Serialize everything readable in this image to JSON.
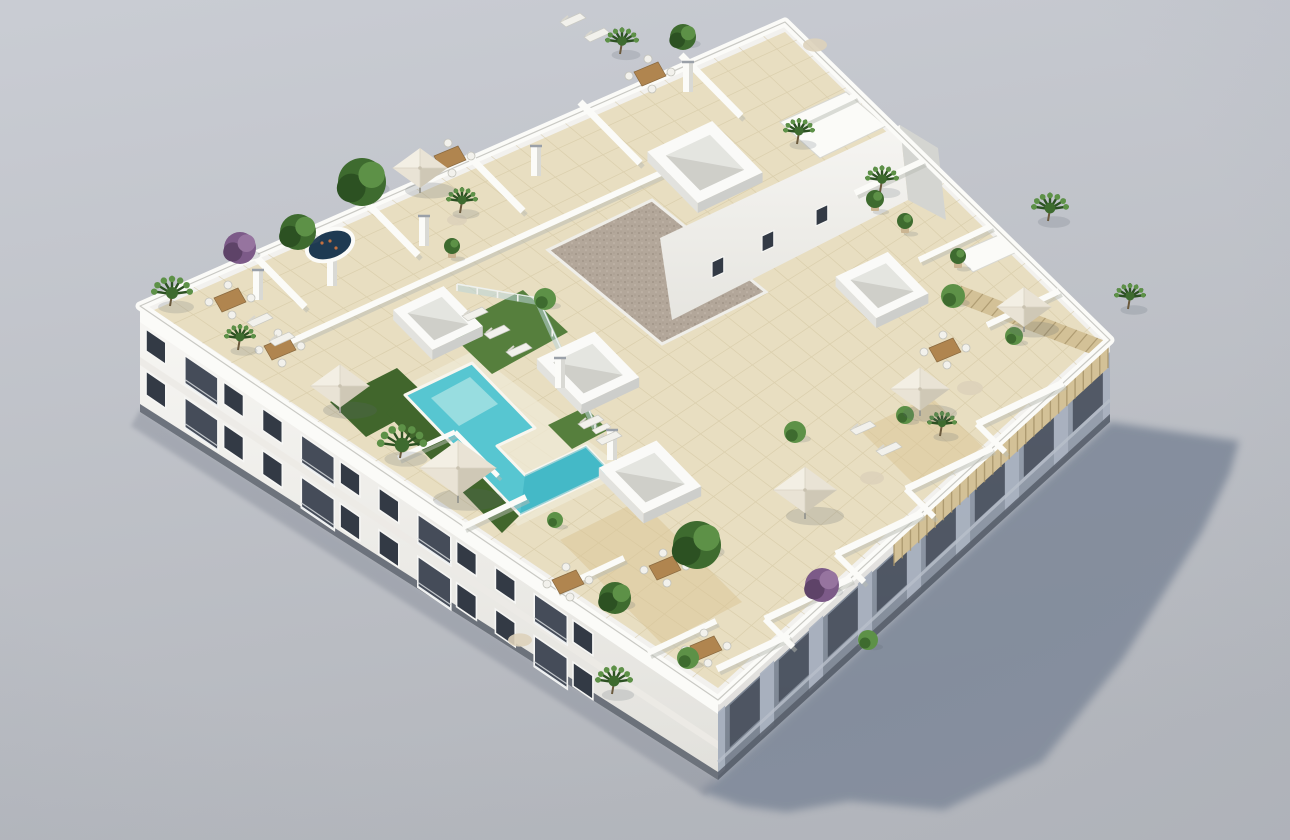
{
  "meta": {
    "title": "Aerial 3D render of a white apartment building with rooftop terraces and communal pool",
    "type": "architectural-render",
    "visible_text": ""
  },
  "scene": {
    "palette": {
      "sky_top": "#c9ccd3",
      "sky_bottom": "#b4b7bd",
      "wall": "#f2f1ee",
      "wall_bright": "#fbfbf8",
      "wall_shade": "#d8d8d3",
      "facade_top": "#f7f6f3",
      "facade_bottom": "#e2e1dc",
      "facade_right_top": "#9ca5b3",
      "facade_right_bottom": "#79828f",
      "recess": "#454c59",
      "window": "#333a45",
      "frame": "#f6f6f4",
      "tile": "#e8dec1",
      "tile_line": "#d2c5a0",
      "wood": "#d9c394",
      "gravel": "#b3a79a",
      "pool": "#57c6d1",
      "pool_light": "#a3e1e3",
      "pool_deep": "#2fa8ba",
      "grass": "#567f3d",
      "grass_dark": "#41662c",
      "plant": "#3e6b2f",
      "plant_dark": "#2c5122",
      "plant_light": "#5d9147",
      "purple": "#7c5a88",
      "purple_dark": "#5e4368",
      "parasol": "#e9e3d5",
      "parasol_lit": "#f3efe4",
      "parasol_shade": "#cfc8b6",
      "jacuzzi": "#1e3a52",
      "furniture_wood": "#b0854f",
      "white_furn": "#f2f1ec",
      "glass": "#bcd6da",
      "shadow": "#7e8899",
      "pergola": "#d3c197",
      "pergola_dark": "#a8956b",
      "base_dark": "#565d68"
    },
    "geo": {
      "quad": {
        "W": [
          140,
          306
        ],
        "N": [
          785,
          22
        ],
        "E": [
          1110,
          340
        ],
        "S": [
          718,
          700
        ]
      },
      "roof": "785,22 1110,340 718,700 140,306",
      "roof_floor": "785,32 1098,340 718,688 154,310",
      "facade_left": "140,306 718,700 718,780 140,412",
      "facade_left_top": "140,306 718,700 718,714 140,322",
      "facade_left_mid": "140,357 718,741 718,749 140,365",
      "facade_left_base": "140,404 718,772 718,780 140,412",
      "facade_right": "718,700 1110,340 1110,422 718,780",
      "facade_right_top": "718,700 1110,340 1110,354 718,714",
      "facade_right_base": "718,772 1110,414 1110,422 718,780",
      "shadow": "718,778 1110,422 1150,428 1239,441 1230,473 1202,532 1123,659 1042,762 944,810 849,801 787,812 742,806 700,791",
      "ground_contact": "140,410 718,778 706,796 131,426",
      "pool": "405,395 472,363 535,428 497,446 525,475 586,446 611,472 520,515",
      "pool_step": "431,398 470,377 498,404 459,426",
      "pool_deep": "525,475 586,446 611,472 520,515",
      "pool_deck": "392,392 473,351 628,472 518,526",
      "grass1": "446,330 523,290 568,332 492,374",
      "grass2": "330,402 397,368 432,401 366,437",
      "grass3": "548,425 585,407 608,430 572,449",
      "grass4": "404,395 520,515 502,533 386,413",
      "gravel": "548,250 652,200 766,292 662,344",
      "bulk_wall": "660,238 900,125 908,200 672,320",
      "bulk_side": "900,125 938,148 946,220 908,200",
      "planter1": "780,122 846,92 886,126 820,158",
      "planter2": "955,254 1001,234 1019,251 973,272",
      "pergola": "1108,342 1108,368 894,564 894,540",
      "pergola2": "962,286 1108,342 1096,356 950,300",
      "wood1": "560,540 640,500 742,602 662,644",
      "wood3": "860,430 930,396 986,450 916,486"
    },
    "tiles": {
      "u_lines": 26,
      "v_lines": 20
    },
    "walls": [
      [
        252,
        253,
        305,
        307,
        7
      ],
      [
        365,
        201,
        418,
        255,
        7
      ],
      [
        467,
        154,
        523,
        211,
        7
      ],
      [
        580,
        102,
        640,
        163,
        7
      ],
      [
        681,
        55,
        741,
        116,
        7
      ],
      [
        268,
        352,
        672,
        168,
        6
      ],
      [
        855,
        96,
        792,
        126,
        6
      ],
      [
        923,
        161,
        855,
        193,
        6
      ],
      [
        991,
        226,
        919,
        260,
        6
      ],
      [
        1059,
        291,
        987,
        325,
        6
      ],
      [
        1063,
        383,
        977,
        424,
        7
      ],
      [
        992,
        448,
        906,
        489,
        7
      ],
      [
        922,
        513,
        836,
        554,
        7
      ],
      [
        851,
        578,
        765,
        619,
        7
      ],
      [
        789,
        635,
        717,
        669,
        7
      ],
      [
        977,
        424,
        1005,
        452,
        6
      ],
      [
        906,
        489,
        934,
        517,
        6
      ],
      [
        836,
        554,
        864,
        582,
        6
      ],
      [
        765,
        619,
        793,
        647,
        6
      ],
      [
        648,
        653,
        716,
        621,
        6
      ],
      [
        556,
        590,
        624,
        558,
        6
      ],
      [
        463,
        527,
        526,
        497,
        6
      ],
      [
        398,
        458,
        455,
        432,
        5
      ],
      [
        455,
        432,
        498,
        476,
        5
      ]
    ],
    "chimneys": [
      [
        536,
        176
      ],
      [
        424,
        246
      ],
      [
        332,
        286
      ],
      [
        560,
        388
      ],
      [
        612,
        460
      ],
      [
        688,
        92
      ],
      [
        258,
        300
      ]
    ],
    "boxes": [
      [
        705,
        162,
        72
      ],
      [
        588,
        368,
        64
      ],
      [
        650,
        477,
        64
      ],
      [
        882,
        285,
        58
      ],
      [
        438,
        318,
        56
      ]
    ],
    "bulk_windows": [
      [
        712,
        262
      ],
      [
        762,
        236
      ],
      [
        816,
        210
      ]
    ],
    "fences": [
      [
        457,
        288,
        538,
        302
      ],
      [
        538,
        302,
        595,
        428
      ]
    ],
    "stairs": [
      [
        583,
        422
      ],
      [
        592,
        430
      ],
      [
        601,
        438
      ]
    ],
    "plants": [
      {
        "t": "palm",
        "x": 170,
        "y": 300,
        "r": 20
      },
      {
        "t": "purple",
        "x": 240,
        "y": 248,
        "r": 16
      },
      {
        "t": "tree",
        "x": 298,
        "y": 232,
        "r": 18
      },
      {
        "t": "tree",
        "x": 362,
        "y": 182,
        "r": 24
      },
      {
        "t": "palm",
        "x": 460,
        "y": 207,
        "r": 15
      },
      {
        "t": "bush",
        "x": 545,
        "y": 299,
        "r": 11
      },
      {
        "t": "palm",
        "x": 400,
        "y": 452,
        "r": 24
      },
      {
        "t": "palm",
        "x": 620,
        "y": 48,
        "r": 16
      },
      {
        "t": "tree",
        "x": 683,
        "y": 37,
        "r": 13
      },
      {
        "t": "palm",
        "x": 797,
        "y": 138,
        "r": 15
      },
      {
        "t": "palm",
        "x": 880,
        "y": 186,
        "r": 16
      },
      {
        "t": "palm",
        "x": 1048,
        "y": 215,
        "r": 18
      },
      {
        "t": "bush",
        "x": 953,
        "y": 296,
        "r": 12
      },
      {
        "t": "palm",
        "x": 1128,
        "y": 303,
        "r": 15
      },
      {
        "t": "tree",
        "x": 697,
        "y": 545,
        "r": 24
      },
      {
        "t": "tree",
        "x": 615,
        "y": 598,
        "r": 16
      },
      {
        "t": "purple",
        "x": 822,
        "y": 585,
        "r": 17
      },
      {
        "t": "palm",
        "x": 612,
        "y": 688,
        "r": 18
      },
      {
        "t": "bush",
        "x": 688,
        "y": 658,
        "r": 11
      },
      {
        "t": "palm",
        "x": 940,
        "y": 430,
        "r": 14
      },
      {
        "t": "bush",
        "x": 795,
        "y": 432,
        "r": 11
      },
      {
        "t": "bush",
        "x": 905,
        "y": 415,
        "r": 9
      },
      {
        "t": "pot",
        "x": 875,
        "y": 205,
        "r": 9
      },
      {
        "t": "pot",
        "x": 905,
        "y": 227,
        "r": 8
      },
      {
        "t": "pot",
        "x": 958,
        "y": 262,
        "r": 8
      },
      {
        "t": "bush",
        "x": 555,
        "y": 520,
        "r": 8
      },
      {
        "t": "bush",
        "x": 868,
        "y": 640,
        "r": 10
      },
      {
        "t": "palm",
        "x": 238,
        "y": 344,
        "r": 15
      },
      {
        "t": "pot",
        "x": 452,
        "y": 252,
        "r": 8
      },
      {
        "t": "bush",
        "x": 1014,
        "y": 336,
        "r": 9
      }
    ],
    "parasols": [
      {
        "x": 340,
        "y": 386,
        "s": 54
      },
      {
        "x": 458,
        "y": 468,
        "s": 70
      },
      {
        "x": 420,
        "y": 168,
        "s": 50
      },
      {
        "x": 805,
        "y": 490,
        "s": 58
      },
      {
        "x": 920,
        "y": 389,
        "s": 54
      },
      {
        "x": 1024,
        "y": 307,
        "s": 50
      }
    ],
    "tables": [
      [
        230,
        300
      ],
      [
        280,
        348
      ],
      [
        568,
        582
      ],
      [
        665,
        568
      ],
      [
        706,
        648
      ],
      [
        945,
        350
      ],
      [
        450,
        158
      ],
      [
        650,
        74
      ]
    ],
    "rugs": [
      [
        970,
        388,
        13
      ],
      [
        872,
        478,
        12
      ],
      [
        815,
        45,
        12
      ],
      [
        457,
        220,
        10
      ],
      [
        520,
        640,
        12
      ]
    ],
    "loungers": [
      [
        462,
        316
      ],
      [
        484,
        334
      ],
      [
        506,
        352
      ],
      [
        578,
        424
      ],
      [
        596,
        440
      ],
      [
        850,
        430
      ],
      [
        876,
        451
      ],
      [
        247,
        322
      ],
      [
        269,
        341
      ],
      [
        560,
        22
      ],
      [
        584,
        37
      ]
    ],
    "jacuzzi": {
      "x": 330,
      "y": 245,
      "rx": 22,
      "ry": 13,
      "rot": -20
    },
    "windows_left": {
      "origin": [
        146,
        315
      ],
      "dir": [
        0.826,
        0.563
      ],
      "step": 47,
      "count": 12,
      "rows": [
        {
          "dy": 14,
          "h": 22
        },
        {
          "dy": 56,
          "h": 24
        }
      ],
      "balcony_every": 3,
      "win_w": 24,
      "balc_w": 40
    },
    "facade_right_cfg": {
      "bays": 8,
      "recess_dy": 16,
      "recess_h": 42,
      "pillar_w": 0.018
    },
    "pergola_slats": 26,
    "pergola2_slats": 14
  }
}
